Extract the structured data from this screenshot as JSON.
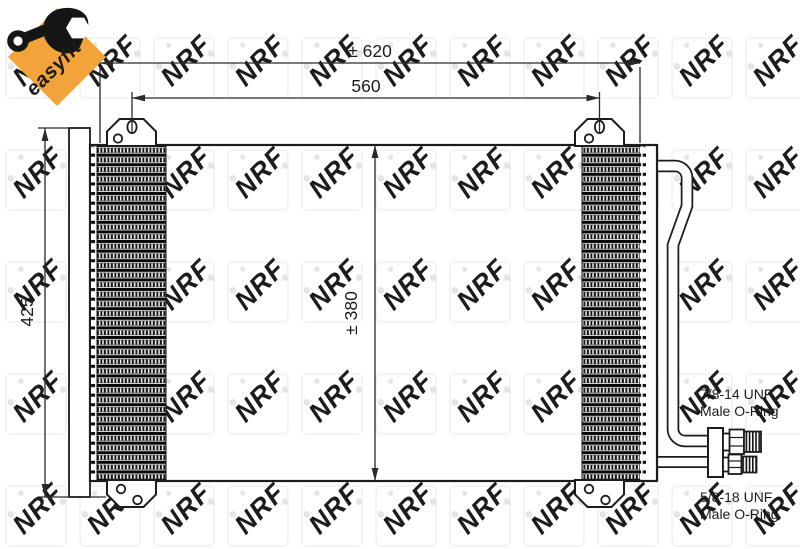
{
  "brand": {
    "easyfit_label": "easyfit",
    "watermark_text": "NRF",
    "orange": "#F2A43A",
    "green": "#267326"
  },
  "dimensions": {
    "overall_width": "± 620",
    "mounting_width": "560",
    "height": "425",
    "core_height": "± 380"
  },
  "fittings": {
    "top": {
      "thread": "7/8-14 UNF",
      "type": "Male O-Ring"
    },
    "bottom": {
      "thread": "5/8-18 UNF",
      "type": "Male O-Ring"
    }
  }
}
